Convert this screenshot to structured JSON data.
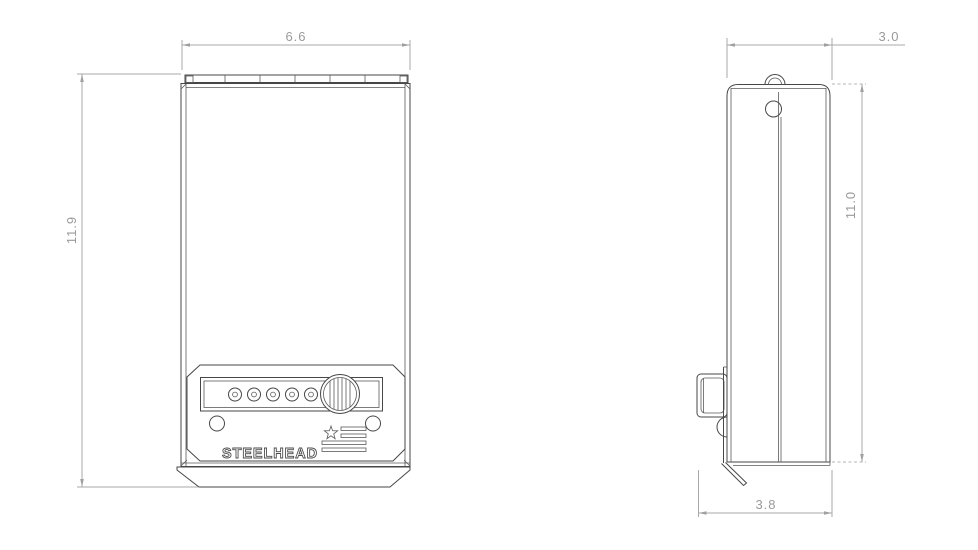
{
  "drawing": {
    "title": "lockbox-dimension-drawing",
    "brand": "STEELHEAD",
    "views": {
      "front": {
        "label": "front-view",
        "width_dim": "6.6",
        "height_dim": "11.9"
      },
      "side": {
        "label": "side-view",
        "depth_dim": "3.0",
        "height_dim": "11.0",
        "total_depth_dim": "3.8"
      }
    },
    "icons": {
      "logo": "us-flag-star-stripes"
    },
    "colors": {
      "background": "#ffffff",
      "geometry_line": "#474747",
      "dimension_line": "#a8a8a8",
      "dimension_text": "#9a9a9a"
    }
  }
}
